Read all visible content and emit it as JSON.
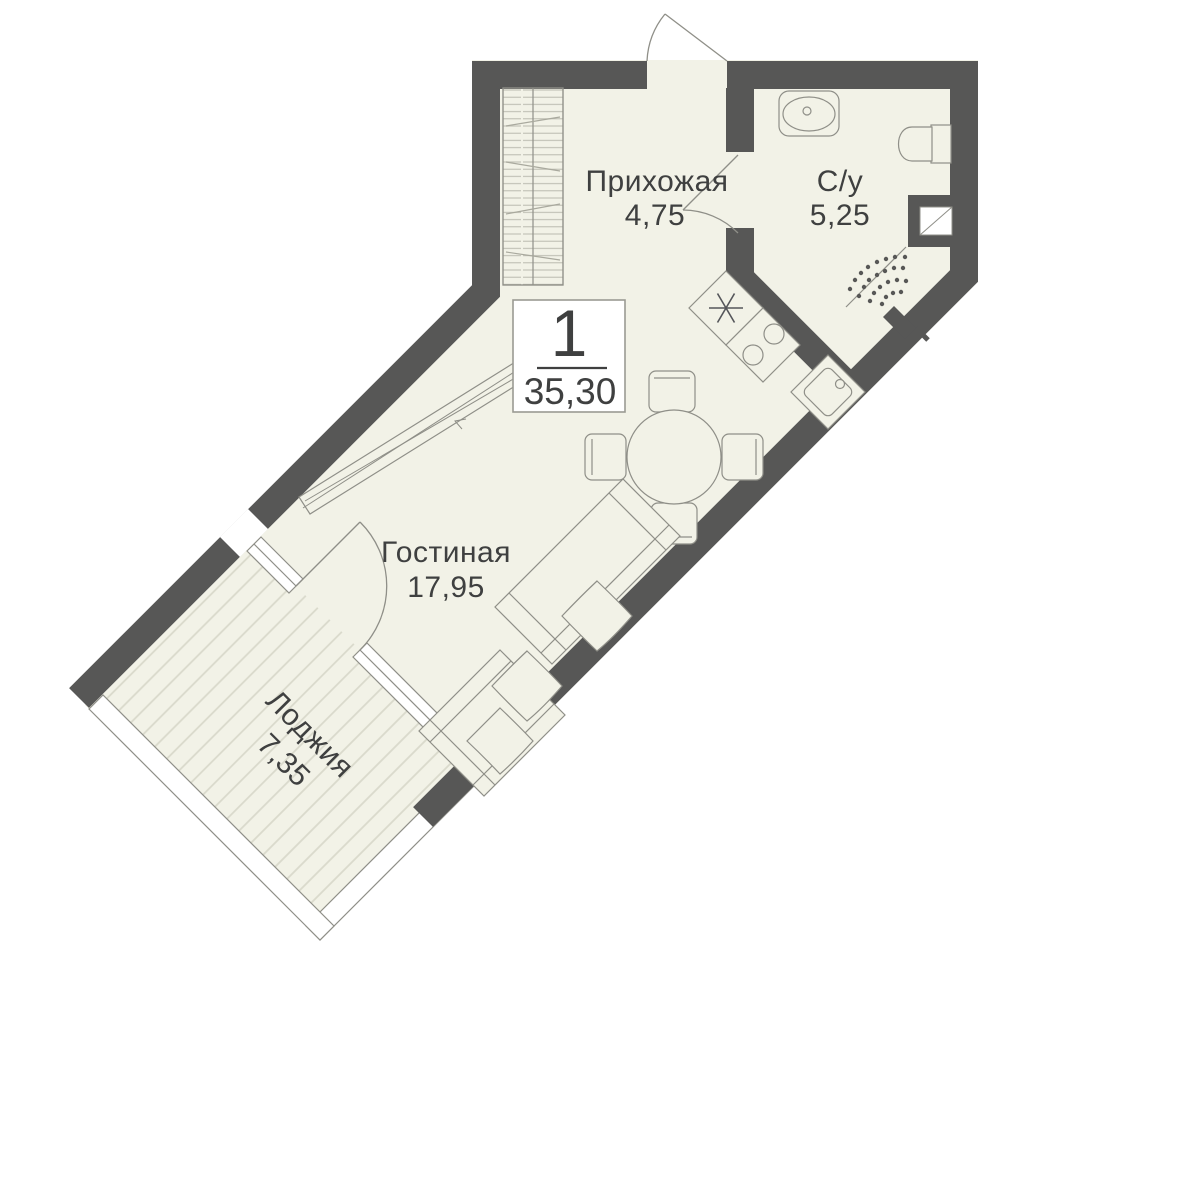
{
  "badge": {
    "rooms_count": "1",
    "total_area": "35,30"
  },
  "rooms": [
    {
      "id": "hallway",
      "name": "Прихожая",
      "area": "4,75"
    },
    {
      "id": "bathroom",
      "name": "С/у",
      "area": "5,25"
    },
    {
      "id": "living",
      "name": "Гостиная",
      "area": "17,95"
    },
    {
      "id": "loggia",
      "name": "Лоджия",
      "area": "7,35"
    }
  ],
  "icons": {
    "shower": "shower-spray-icon",
    "vent": "ventilation-shaft-icon",
    "appliance": "asterisk-appliance-icon"
  },
  "colors": {
    "wall": "#575756",
    "floor": "#f2f2e7",
    "stripe": "#d9d9cb",
    "line": "#8f8f88",
    "text": "#3f4040",
    "badgeBorder": "#9a9a93",
    "white": "#ffffff"
  }
}
